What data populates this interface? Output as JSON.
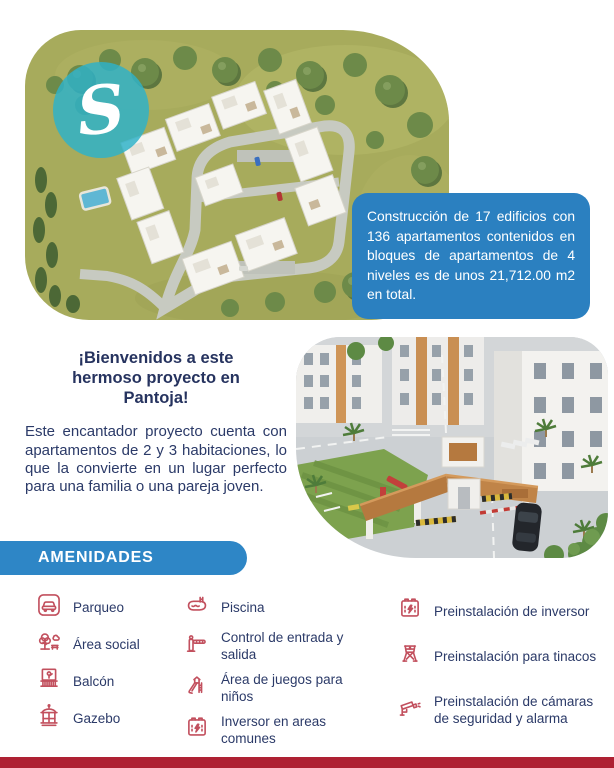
{
  "hero": {
    "logo_letter": "S",
    "info_box_text": "Construcción de 17 edificios con 136 apartamentos contenidos en bloques de apartamentos de 4 niveles es de unos 21,712.00 m2 en total."
  },
  "intro": {
    "heading": "¡Bienvenidos a este hermoso proyecto en Pantoja!",
    "body": "Este encantador proyecto cuenta con apartamentos de 2 y 3 habitaciones, lo que la convierte en un lugar perfecto para una familia o una pareja joven."
  },
  "amenities": {
    "title": "AMENIDADES",
    "columns": [
      {
        "items": [
          {
            "icon": "car-icon",
            "label": "Parqueo"
          },
          {
            "icon": "tree-icon",
            "label": "Área social"
          },
          {
            "icon": "balcony-icon",
            "label": "Balcón"
          },
          {
            "icon": "gazebo-icon",
            "label": "Gazebo"
          }
        ]
      },
      {
        "items": [
          {
            "icon": "pool-icon",
            "label": "Piscina"
          },
          {
            "icon": "barrier-gate-icon",
            "label": "Control de entrada y salida"
          },
          {
            "icon": "playground-icon",
            "label": "Área de juegos para niños"
          },
          {
            "icon": "battery-inverter-icon",
            "label": "Inversor en areas comunes"
          }
        ]
      },
      {
        "items": [
          {
            "icon": "battery-inverter-icon",
            "label": "Preinstalación de inversor"
          },
          {
            "icon": "water-tank-icon",
            "label": "Preinstalación para tinacos"
          },
          {
            "icon": "security-camera-icon",
            "label": "Preinstalación de cámaras de seguridad y alarma"
          }
        ]
      }
    ]
  },
  "colors": {
    "accent_blue": "#2b81c1",
    "navy_text": "#2b3a68",
    "icon_red": "#c2505e",
    "footer_red": "#ae2133",
    "logo_teal": "#2fb2c8"
  }
}
